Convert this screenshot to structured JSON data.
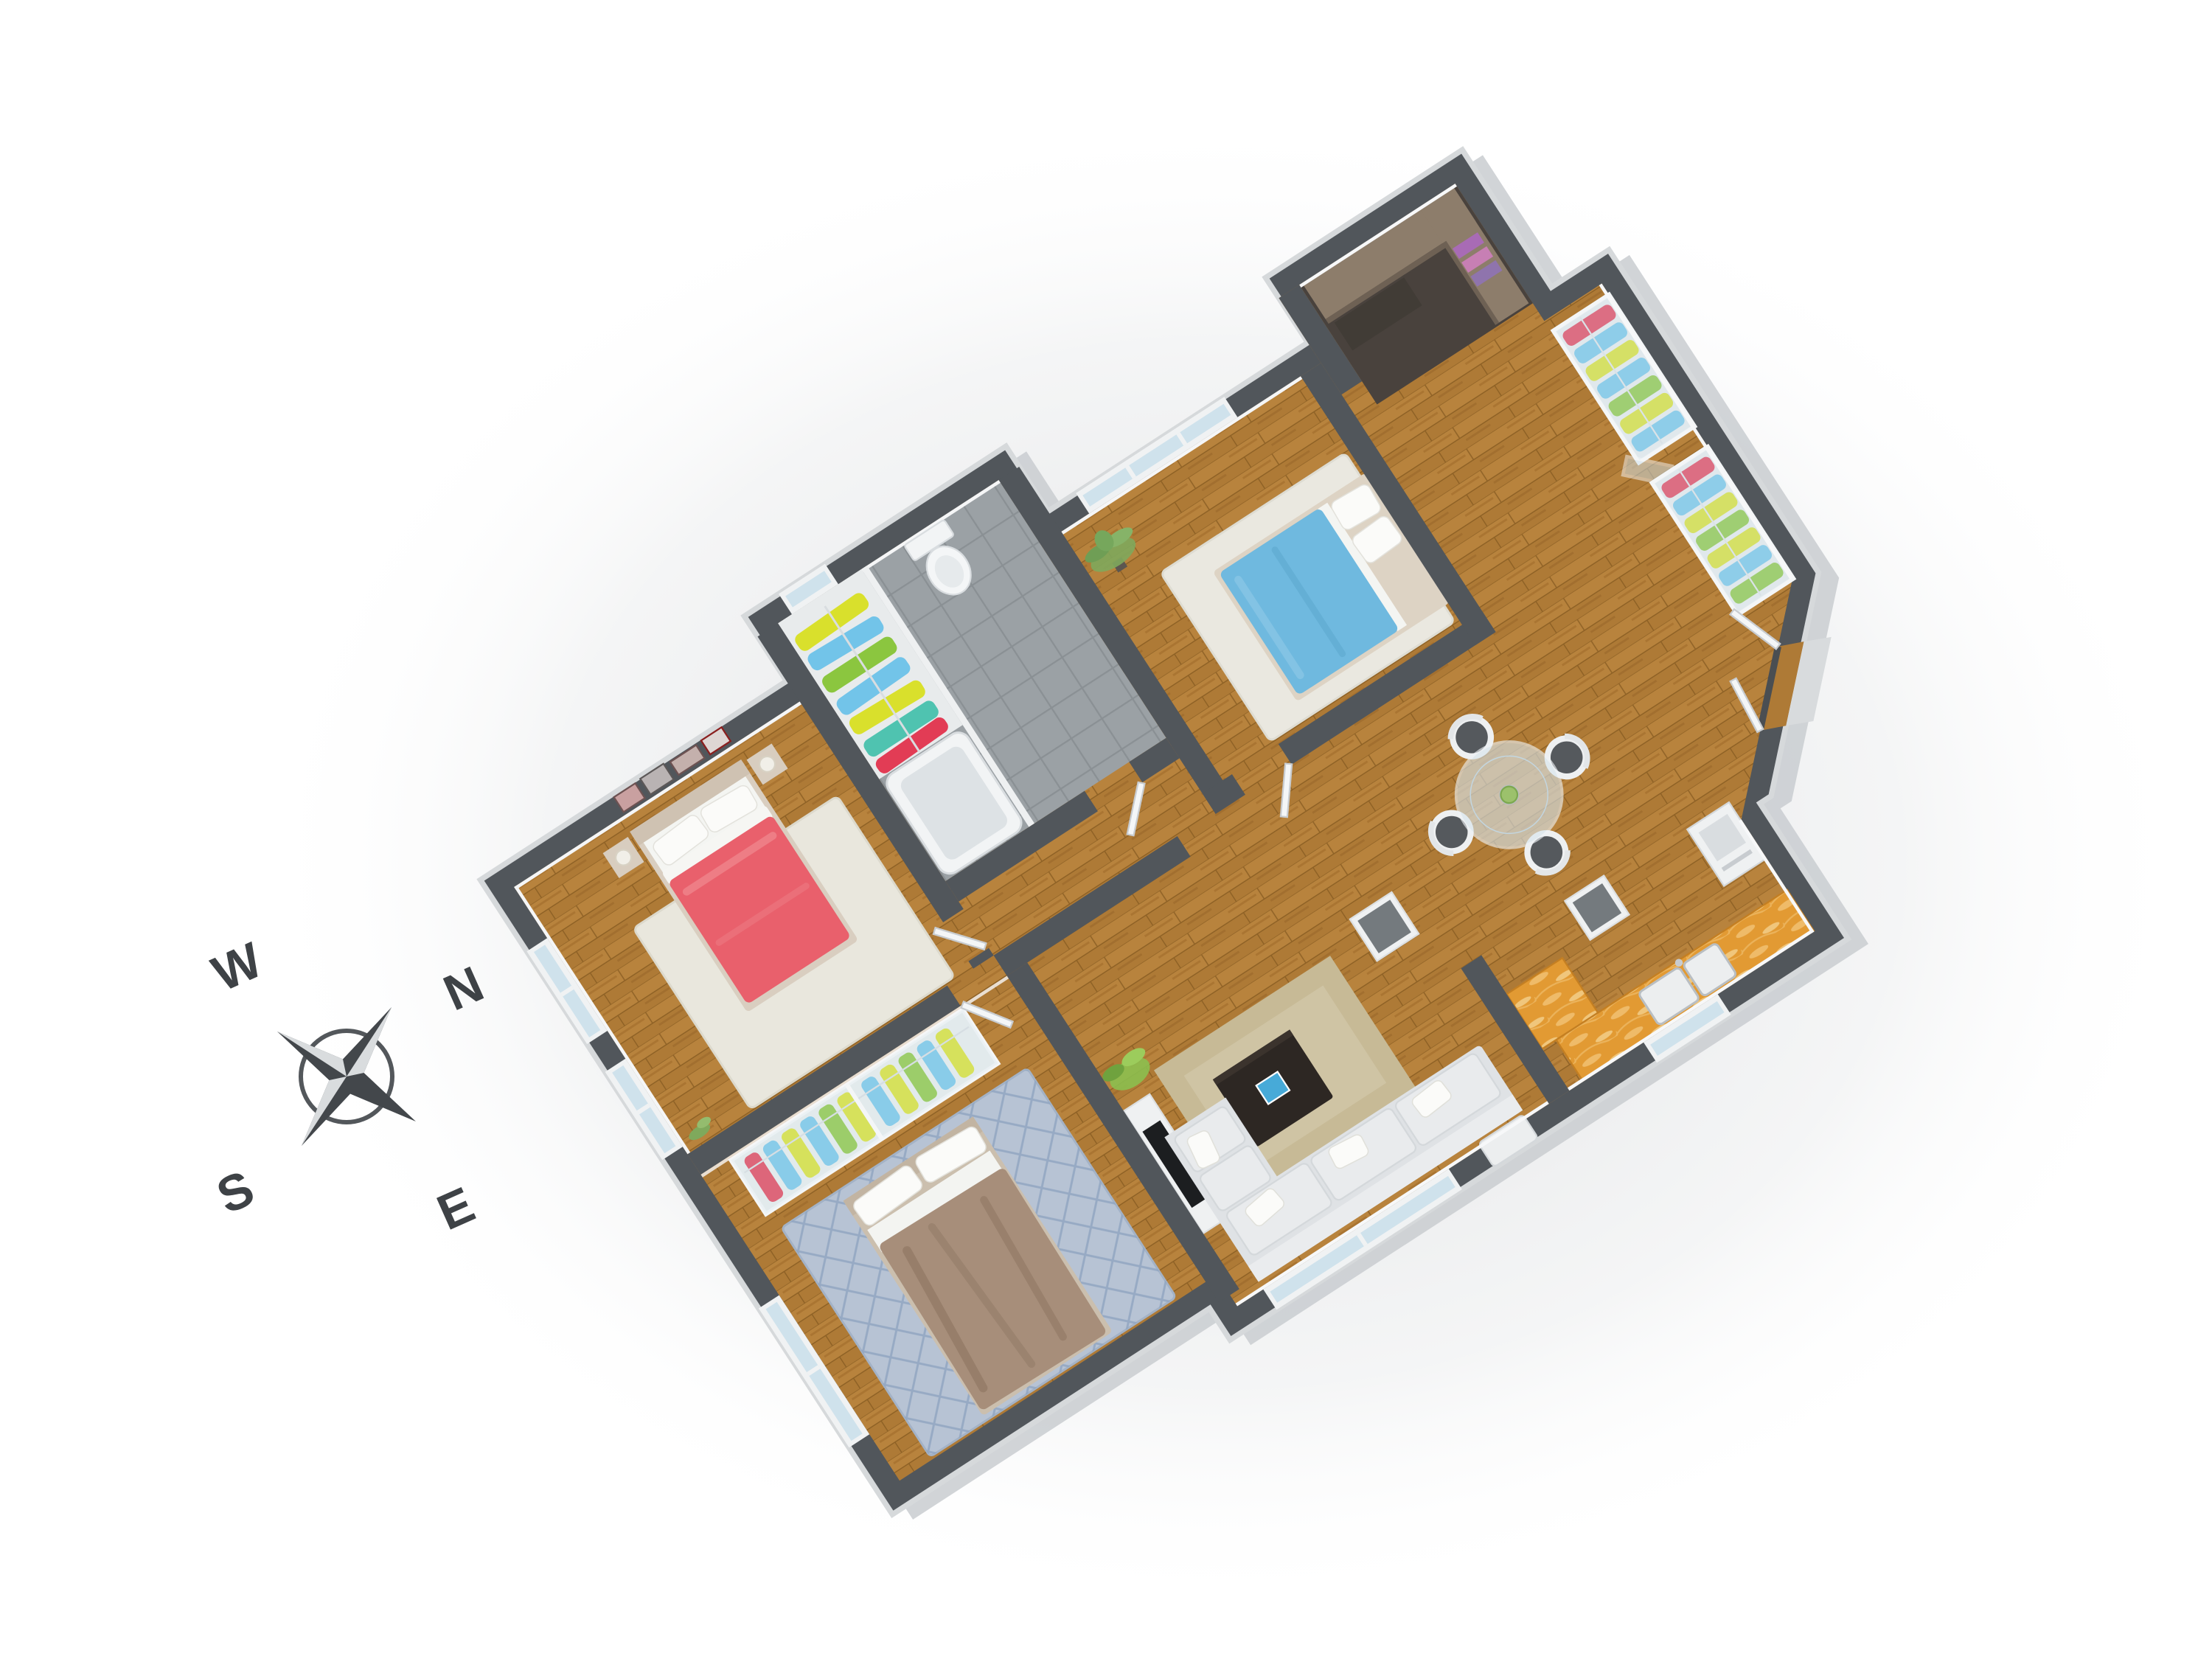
{
  "title": "3D apartment floor plan render",
  "compass": {
    "w": "W",
    "n": "N",
    "s": "S",
    "e": "E"
  },
  "colors": {
    "wall": "#51565b",
    "wall_inner_face": "#f5f6f7",
    "outer_face": "#c9cdd0",
    "floor_wood": "#ae7a36",
    "tile": "#9ba1a5",
    "office_floor": "#49423d",
    "rug_cream": "#e9e7dd",
    "rug_white": "#eae8e0",
    "rug_blue": "#b7c3d4",
    "rug_tan": "#c7ba96",
    "bed_red": "#e9606c",
    "bed_blue": "#6fb9df",
    "bed_taupe": "#a78e7a",
    "bed_frame": "#d9cec0",
    "pillow": "#fbfbf9",
    "sofa": "#dfe2e5",
    "cushion": "#e9ebed",
    "coffee_table": "#2d2723",
    "book_blue": "#47aad8",
    "counter_orange": "#e29a33",
    "desk_wood": "#8d7d6b",
    "cloth_red": "#e23c55",
    "cloth_blue": "#72c4e9",
    "cloth_yellow": "#d9e02c",
    "cloth_green": "#8bc63f",
    "cloth_teal": "#4fc3b0",
    "chair_seat": "#55595d",
    "white_furniture": "#f2f4f5",
    "glass": "#cfe2ec",
    "plant_green": "#7fa95c",
    "plant_bright": "#8cbf4f",
    "tv_black": "#1c1e20",
    "compass_dark": "#43474b",
    "compass_light": "#d9dcde",
    "compass_text": "#3e4246"
  },
  "rooms": [
    {
      "name": "master-bedroom",
      "floor": "wood",
      "furniture": [
        "double-bed-red",
        "nightstand-left",
        "nightstand-right",
        "table-lamps",
        "cream-rug",
        "picture-frames",
        "corner-plant",
        "windows"
      ]
    },
    {
      "name": "bathroom",
      "floor": "gray-tile",
      "furniture": [
        "toilet",
        "bathtub",
        "closet-hanging-clothes",
        "small-window"
      ]
    },
    {
      "name": "bedroom-blue",
      "floor": "wood",
      "furniture": [
        "double-bed-blue",
        "white-rug",
        "potted-palm",
        "window-band"
      ]
    },
    {
      "name": "study-nook",
      "floor": "dark",
      "furniture": [
        "l-shaped-desk",
        "shelf-books"
      ]
    },
    {
      "name": "dining-area",
      "floor": "wood",
      "furniture": [
        "round-glass-table",
        "four-chairs",
        "green-centerpiece",
        "storage-columns",
        "sliding-glass-wardrobes",
        "corner-plant"
      ]
    },
    {
      "name": "bedroom-taupe",
      "floor": "wood",
      "furniture": [
        "double-bed-taupe",
        "wardrobe-hanging-clothes",
        "diamond-rug",
        "wall-tv"
      ]
    },
    {
      "name": "living-room",
      "floor": "wood",
      "furniture": [
        "l-shaped-sofa",
        "white-pillows",
        "coffee-table",
        "blue-book",
        "tan-rug",
        "tv-console",
        "ottoman"
      ]
    },
    {
      "name": "kitchen",
      "floor": "wood",
      "furniture": [
        "orange-l-counter",
        "double-sink",
        "faucet",
        "white-appliance",
        "window"
      ]
    },
    {
      "name": "entry",
      "floor": "wood",
      "furniture": [
        "double-entry-doors",
        "threshold",
        "porch-step"
      ]
    }
  ]
}
